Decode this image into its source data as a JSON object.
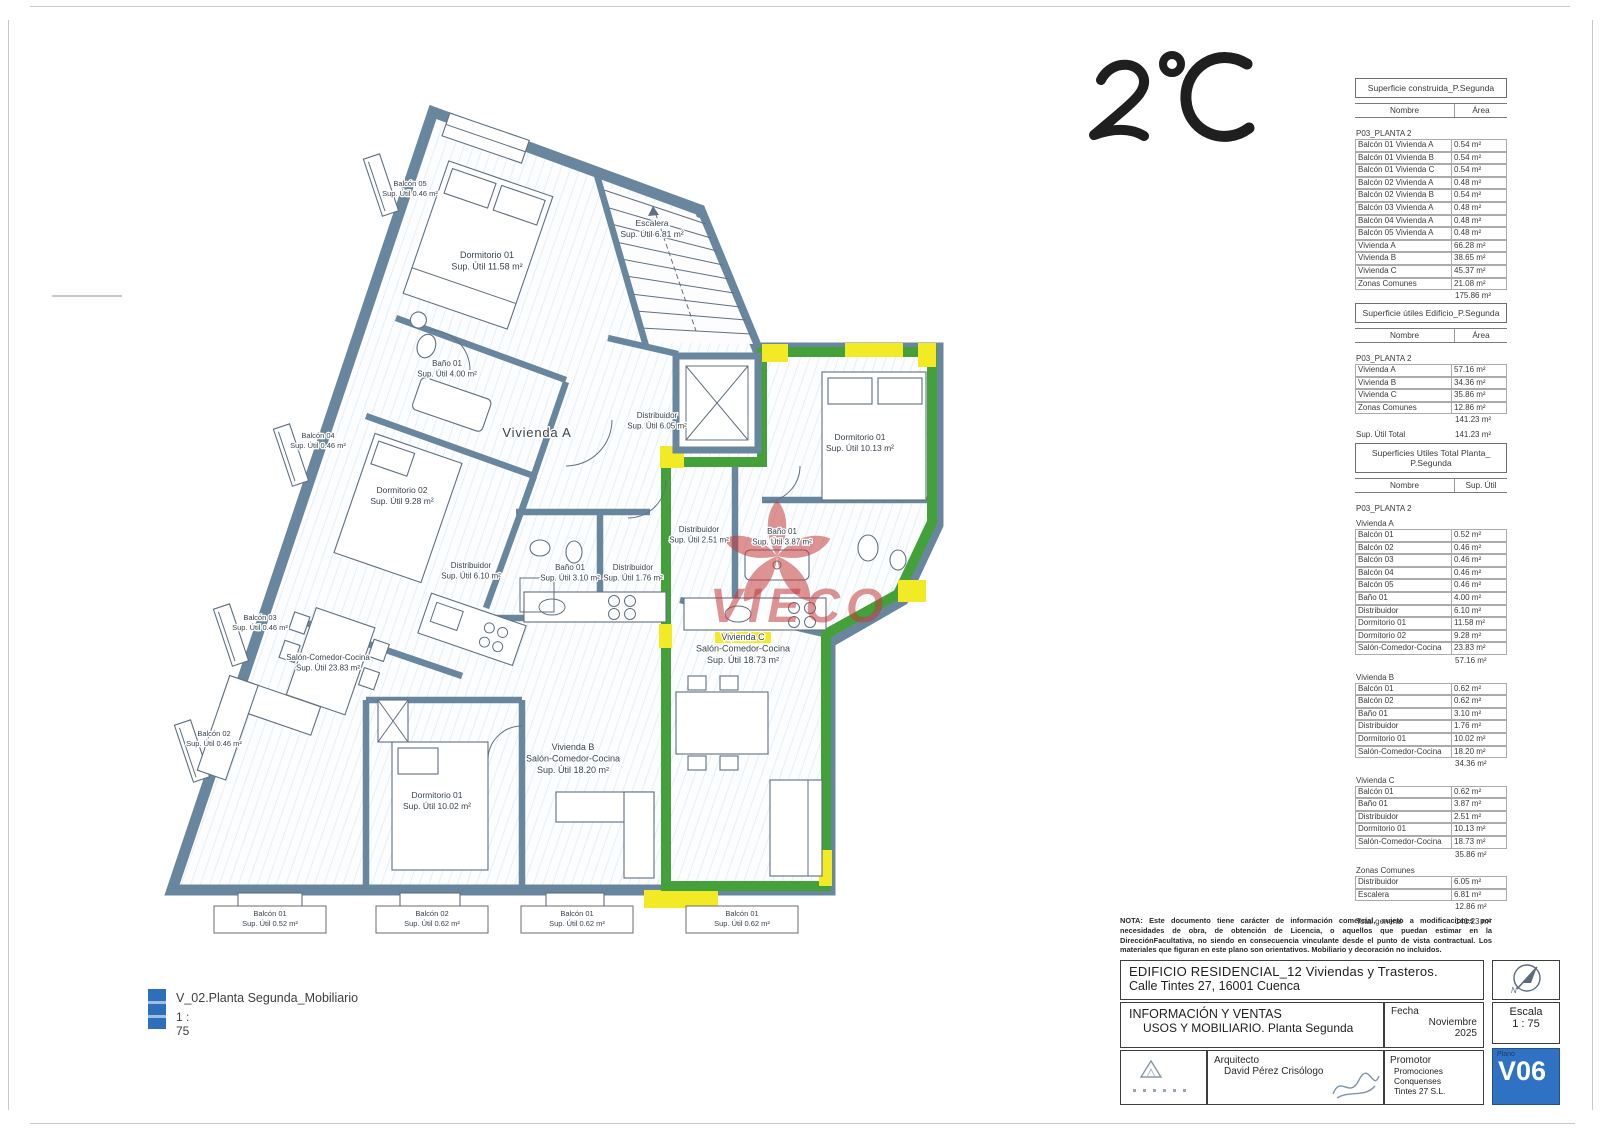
{
  "colors": {
    "wall": "#68879e",
    "green": "#44a038",
    "yellow": "#f2ea25",
    "wm": "#c23b3b",
    "plano": "#2f72c4",
    "legendblue": "#2e6fba"
  },
  "annotation": {
    "handwritten": "2°C"
  },
  "watermark": {
    "text": "VIECO"
  },
  "legend": {
    "title": "V_02.Planta Segunda_Mobiliario",
    "scale": "1 : 75"
  },
  "titleblock": {
    "note": "NOTA: Este documento tiene carácter de información comercial, sujeto a modificaciones por necesidades de obra, de obtención de Licencia, o aquellos que puedan estimar en la DirecciónFacultativa, no siendo en consecuencia vinculante desde el punto de vista contractual. Los materiales que figuran en este plano son orientativos. Mobiliario y decoración no incluidos.",
    "project_line1": "EDIFICIO RESIDENCIAL_12 Viviendas y Trasteros.",
    "project_line2": "Calle Tintes 27, 16001 Cuenca",
    "doc_line1": "INFORMACIÓN Y VENTAS",
    "doc_line2": "USOS Y MOBILIARIO. Planta Segunda",
    "fecha_label": "Fecha",
    "fecha_value1": "Noviembre",
    "fecha_value2": "2025",
    "escala_label": "Escala",
    "escala_value": "1 : 75",
    "plano_label": "Plano",
    "plano_value": "V06",
    "arquitecto_label": "Arquitecto",
    "arquitecto_value": "David Pérez Crisólogo",
    "promotor_label": "Promotor",
    "promotor_value1": "Promociones Conquenses",
    "promotor_value2": "Tintes 27  S.L."
  },
  "tables": [
    {
      "title": "Superficie construida_P.Segunda",
      "cols": [
        "Nombre",
        "Área"
      ],
      "rows": [
        {
          "t": "group",
          "l": "P03_PLANTA 2"
        },
        {
          "t": "row",
          "l": "Balcón 01 Vivienda A",
          "v": "0.54 m²"
        },
        {
          "t": "row",
          "l": "Balcón 01 Vivienda B",
          "v": "0.54 m²"
        },
        {
          "t": "row",
          "l": "Balcón 01 Vivienda C",
          "v": "0.54 m²"
        },
        {
          "t": "row",
          "l": "Balcón 02 Vivienda A",
          "v": "0.48 m²"
        },
        {
          "t": "row",
          "l": "Balcón 02 Vivienda B",
          "v": "0.54 m²"
        },
        {
          "t": "row",
          "l": "Balcón 03 Vivienda A",
          "v": "0.48 m²"
        },
        {
          "t": "row",
          "l": "Balcón 04 Vivienda A",
          "v": "0.48 m²"
        },
        {
          "t": "row",
          "l": "Balcón 05 Vivienda A",
          "v": "0.48 m²"
        },
        {
          "t": "row",
          "l": "Vivienda A",
          "v": "66.28 m²"
        },
        {
          "t": "row",
          "l": "Vivienda B",
          "v": "38.65 m²"
        },
        {
          "t": "row",
          "l": "Vivienda C",
          "v": "45.37 m²"
        },
        {
          "t": "row",
          "l": "Zonas Comunes",
          "v": "21.08 m²"
        },
        {
          "t": "sub",
          "v": "175.86 m²"
        },
        {
          "t": "total",
          "l": "Sup. Construida",
          "v": "175.86 m²"
        }
      ]
    },
    {
      "title": "Superficie útiles Edificio_P.Segunda",
      "cols": [
        "Nombre",
        "Área"
      ],
      "rows": [
        {
          "t": "group",
          "l": "P03_PLANTA 2"
        },
        {
          "t": "row",
          "l": "Vivienda A",
          "v": "57.16 m²"
        },
        {
          "t": "row",
          "l": "Vivienda B",
          "v": "34.36 m²"
        },
        {
          "t": "row",
          "l": "Vivienda C",
          "v": "35.86 m²"
        },
        {
          "t": "row",
          "l": "Zonas Comunes",
          "v": "12.86 m²"
        },
        {
          "t": "sub",
          "v": "141.23 m²"
        },
        {
          "t": "total",
          "l": "Sup. Útil Total",
          "v": "141.23 m²"
        }
      ]
    },
    {
      "title": "Superficies Utiles Total Planta_ P.Segunda",
      "cols": [
        "Nombre",
        "Sup. Útil"
      ],
      "rows": [
        {
          "t": "group",
          "l": "P03_PLANTA 2"
        },
        {
          "t": "group",
          "l": "Vivienda A"
        },
        {
          "t": "row",
          "l": "Balcón 01",
          "v": "0.52 m²"
        },
        {
          "t": "row",
          "l": "Balcón 02",
          "v": "0.46 m²"
        },
        {
          "t": "row",
          "l": "Balcón 03",
          "v": "0.46 m²"
        },
        {
          "t": "row",
          "l": "Balcón 04",
          "v": "0.46 m²"
        },
        {
          "t": "row",
          "l": "Balcón 05",
          "v": "0.46 m²"
        },
        {
          "t": "row",
          "l": "Baño 01",
          "v": "4.00 m²"
        },
        {
          "t": "row",
          "l": "Distribuidor",
          "v": "6.10 m²"
        },
        {
          "t": "row",
          "l": "Dormitorio 01",
          "v": "11.58 m²"
        },
        {
          "t": "row",
          "l": "Dormitorio 02",
          "v": "9.28 m²"
        },
        {
          "t": "row",
          "l": "Salón-Comedor-Cocina",
          "v": "23.83 m²"
        },
        {
          "t": "sub",
          "v": "57.16 m²"
        },
        {
          "t": "group",
          "l": "Vivienda B"
        },
        {
          "t": "row",
          "l": "Balcón 01",
          "v": "0.62 m²"
        },
        {
          "t": "row",
          "l": "Balcón 02",
          "v": "0.62 m²"
        },
        {
          "t": "row",
          "l": "Baño 01",
          "v": "3.10 m²"
        },
        {
          "t": "row",
          "l": "Distribuidor",
          "v": "1.76 m²"
        },
        {
          "t": "row",
          "l": "Dormitorio 01",
          "v": "10.02 m²"
        },
        {
          "t": "row",
          "l": "Salón-Comedor-Cocina",
          "v": "18.20 m²"
        },
        {
          "t": "sub",
          "v": "34.36 m²"
        },
        {
          "t": "group",
          "l": "Vivienda C"
        },
        {
          "t": "row",
          "l": "Balcón 01",
          "v": "0.62 m²"
        },
        {
          "t": "row",
          "l": "Baño 01",
          "v": "3.87 m²"
        },
        {
          "t": "row",
          "l": "Distribuidor",
          "v": "2.51 m²"
        },
        {
          "t": "row",
          "l": "Dormitorio 01",
          "v": "10.13 m²"
        },
        {
          "t": "row",
          "l": "Salón-Comedor-Cocina",
          "v": "18.73 m²"
        },
        {
          "t": "sub",
          "v": "35.86 m²"
        },
        {
          "t": "group",
          "l": "Zonas Comunes"
        },
        {
          "t": "row",
          "l": "Distribuidor",
          "v": "6.05 m²"
        },
        {
          "t": "row",
          "l": "Escalera",
          "v": "6.81 m²"
        },
        {
          "t": "sub",
          "v": "12.86 m²"
        },
        {
          "t": "total",
          "l": "Total general",
          "v": "141.23 m²"
        }
      ]
    }
  ],
  "plan": {
    "labels": [
      {
        "x": 410,
        "y": 186,
        "fs": 7.5,
        "lines": [
          "Balcón 05",
          "Sup. Útil 0.46 m²"
        ]
      },
      {
        "x": 487,
        "y": 258,
        "fs": 9,
        "lines": [
          "Dormitorio 01",
          "Sup. Útil 11.58 m²"
        ]
      },
      {
        "x": 652,
        "y": 226,
        "fs": 8.5,
        "lines": [
          "Escalera",
          "Sup. Útil 6.81 m²"
        ]
      },
      {
        "x": 447,
        "y": 366,
        "fs": 8,
        "lines": [
          "Baño 01",
          "Sup. Útil 4.00 m²"
        ]
      },
      {
        "x": 318,
        "y": 438,
        "fs": 7.5,
        "lines": [
          "Balcón 04",
          "Sup. Útil 0.46 m²"
        ]
      },
      {
        "x": 537,
        "y": 437,
        "fs": 13,
        "lines": [
          "Vivienda A"
        ]
      },
      {
        "x": 657,
        "y": 418,
        "fs": 8,
        "lines": [
          "Distribuidor",
          "Sup. Útil 6.05 m²"
        ]
      },
      {
        "x": 860,
        "y": 440,
        "fs": 8.5,
        "lines": [
          "Dormitorio 01",
          "Sup. Útil 10.13 m²"
        ]
      },
      {
        "x": 402,
        "y": 493,
        "fs": 8.5,
        "lines": [
          "Dormitorio 02",
          "Sup. Útil 9.28 m²"
        ]
      },
      {
        "x": 471,
        "y": 568,
        "fs": 8,
        "lines": [
          "Distribuidor",
          "Sup. Útil 6.10 m²"
        ]
      },
      {
        "x": 570,
        "y": 570,
        "fs": 8,
        "lines": [
          "Baño 01",
          "Sup. Útil 3.10 m²"
        ]
      },
      {
        "x": 633,
        "y": 570,
        "fs": 8,
        "lines": [
          "Distribuidor",
          "Sup. Útil 1.76 m²"
        ]
      },
      {
        "x": 699,
        "y": 532,
        "fs": 8,
        "lines": [
          "Distribuidor",
          "Sup. Útil 2.51 m²"
        ]
      },
      {
        "x": 782,
        "y": 534,
        "fs": 8,
        "lines": [
          "Baño 01",
          "Sup. Útil 3.87 m²"
        ]
      },
      {
        "x": 260,
        "y": 620,
        "fs": 7.5,
        "lines": [
          "Balcón 03",
          "Sup. Útil 0.46 m²"
        ]
      },
      {
        "x": 328,
        "y": 660,
        "fs": 8,
        "lines": [
          "Salón-Comedor-Cocina",
          "Sup. Útil 23.83 m²"
        ]
      },
      {
        "x": 743,
        "y": 640,
        "fs": 9,
        "hl": true,
        "lines": [
          "Vivienda C",
          "Salón-Comedor-Cocina",
          "Sup. Útil 18.73 m²"
        ]
      },
      {
        "x": 214,
        "y": 736,
        "fs": 7.5,
        "lines": [
          "Balcón 02",
          "Sup. Útil 0.46 m²"
        ]
      },
      {
        "x": 573,
        "y": 750,
        "fs": 9,
        "lines": [
          "Vivienda B",
          "Salón-Comedor-Cocina",
          "Sup. Útil 18.20 m²"
        ]
      },
      {
        "x": 437,
        "y": 798,
        "fs": 8.5,
        "lines": [
          "Dormitorio 01",
          "Sup. Útil 10.02 m²"
        ]
      },
      {
        "x": 270,
        "y": 916,
        "fs": 7.5,
        "boxed": true,
        "lines": [
          "Balcón 01",
          "Sup. Útil 0.52 m²"
        ]
      },
      {
        "x": 432,
        "y": 916,
        "fs": 7.5,
        "boxed": true,
        "lines": [
          "Balcón 02",
          "Sup. Útil 0.62 m²"
        ]
      },
      {
        "x": 577,
        "y": 916,
        "fs": 7.5,
        "boxed": true,
        "lines": [
          "Balcón 01",
          "Sup. Útil 0.62 m²"
        ]
      },
      {
        "x": 742,
        "y": 916,
        "fs": 7.5,
        "boxed": true,
        "lines": [
          "Balcón 01",
          "Sup. Útil 0.62 m²"
        ]
      }
    ]
  }
}
